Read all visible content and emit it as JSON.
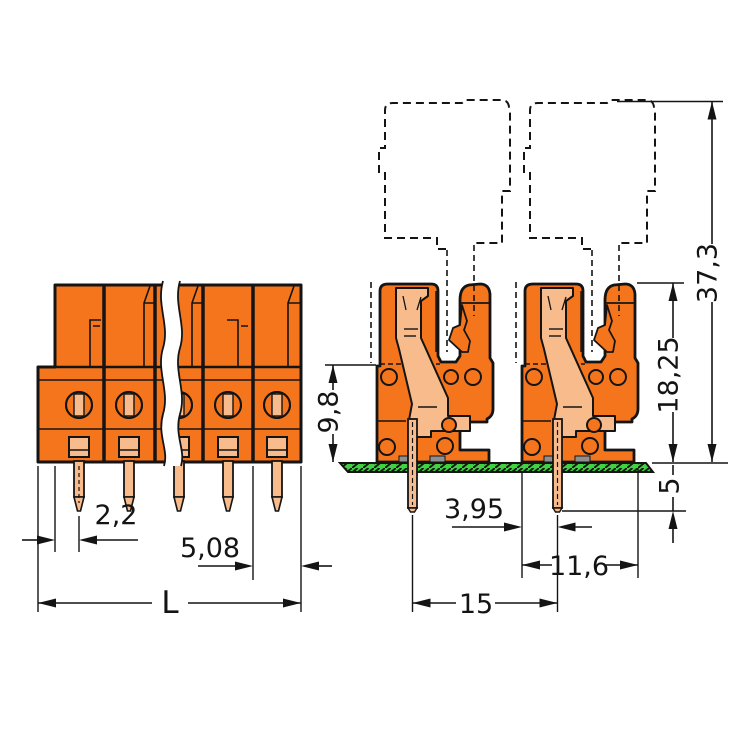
{
  "drawing": {
    "type": "technical-dimension-drawing",
    "subject": "THT female terminal block connector with mating plug outline",
    "views": [
      {
        "name": "front-view",
        "poles_visible": 5,
        "break_lines": true
      },
      {
        "name": "side-view",
        "connectors_shown": 2,
        "mating_plug": "dashed outline",
        "board": "hatched green PCB strip"
      }
    ],
    "colors": {
      "housing_orange": "#F4751C",
      "contact_salmon": "#F8BB8C",
      "pcb_green": "#3FD43F",
      "line_black": "#141414",
      "foot_gray": "#8F8F8F",
      "background": "#FFFFFF"
    },
    "dims": {
      "pin_to_edge": "2,2",
      "pitch": "5,08",
      "overall_length": "L",
      "front_height": "9,8",
      "housing_height": "18,25",
      "total_height": "37,3",
      "pin_below_board": "5",
      "edge_to_pin": "3,95",
      "depth": "11,6",
      "row_pitch": "15"
    }
  }
}
